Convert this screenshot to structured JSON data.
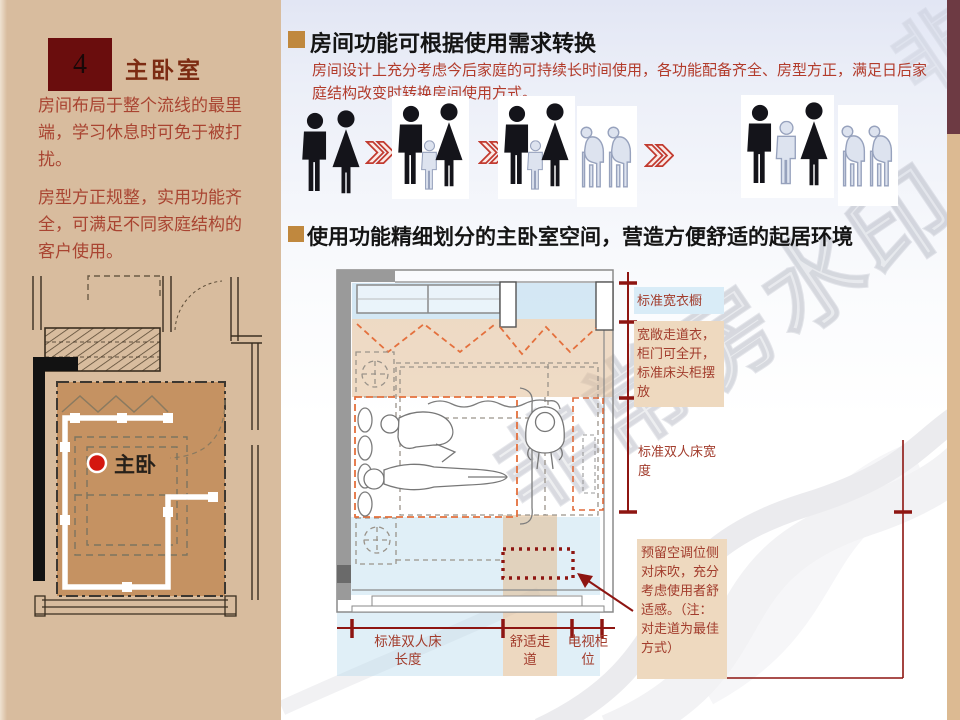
{
  "slide": {
    "sidebar": {
      "section_number": "4",
      "title": "主卧室",
      "paragraphs": {
        "p1": "房间布局于整个流线的最里端，学习休息时可免于被打扰。",
        "p2": "房型方正规整，实用功能齐全，可满足不同家庭结构的客户使用。"
      },
      "plan_label": "主卧"
    },
    "main": {
      "heading1": "房间功能可根据使用需求转换",
      "body1": "房间设计上充分考虑今后家庭的可持续长时间使用，各功能配备齐全、房型方正，满足日后家庭结构改变时转换房间使用方式。",
      "heading2": "使用功能精细划分的主卧室空间，营造方便舒适的起居环境",
      "family_stages": [
        {
          "label": "couple",
          "members": [
            "man",
            "woman"
          ]
        },
        {
          "label": "couple-with-child",
          "members": [
            "man",
            "child",
            "woman"
          ]
        },
        {
          "label": "family-with-child-and-elders",
          "members": [
            "man",
            "child",
            "woman"
          ],
          "elders": [
            "elder",
            "elder"
          ]
        },
        {
          "label": "family-with-grown-child-and-elders",
          "members": [
            "man",
            "teen",
            "woman"
          ],
          "elders": [
            "elder",
            "elder"
          ]
        }
      ],
      "diagram_annotations": {
        "wardrobe": "标准宽衣橱",
        "walkway": "宽敞走道衣，柜门可全开，标准床头柜摆放",
        "bed_width": "标准双人床宽度",
        "ac_note": "预留空调位侧对床吹，充分考虑使用者舒适感。（注：对走道为最佳方式）",
        "bed_length": "标准双人床长度",
        "comfort_walkway": "舒适走道",
        "tv_cabinet": "电视柜位"
      }
    },
    "watermark_text": "非常房水印",
    "icons": {
      "heading_bullet": "square-bullet",
      "stage_arrow": "double-chevron-right",
      "room_marker": "red-dot"
    },
    "colors": {
      "sidebar_bg": "#d8bc9e",
      "number_box": "#6a0d0d",
      "title_text": "#7c2b12",
      "body_red": "#a94431",
      "heading_bullet": "#c0883e",
      "dimension_red": "#8e1511",
      "band_blue": "#badbee",
      "band_tan": "#e1be96",
      "strip_top": "#6d3a43",
      "strip_bottom": "#dcba92",
      "figure_dark": "#14141a",
      "figure_light": "#dde3ef"
    }
  }
}
